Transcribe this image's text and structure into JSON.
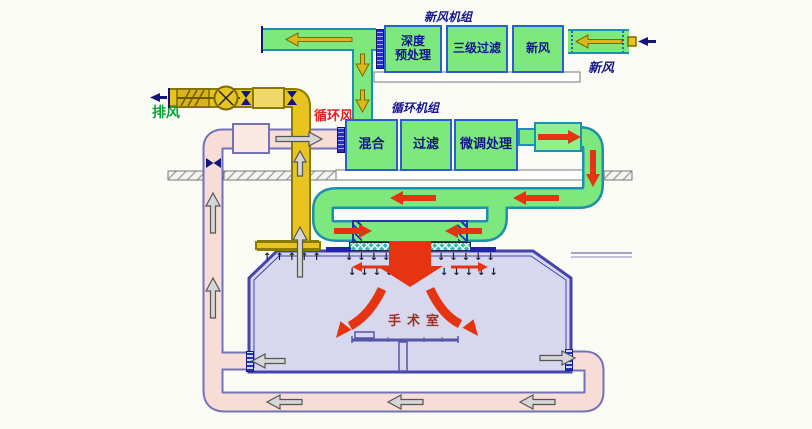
{
  "colors": {
    "green": "#7de87d",
    "duct_border": "#1e8fae",
    "box_border": "#2b5fd0",
    "yellow": "#e7c41f",
    "yellow_dark": "#8a7a00",
    "pink": "#f7ddd6",
    "pink_border": "#7272bb",
    "room_fill": "#d7d7ee",
    "wall": "#4444aa",
    "red": "#e63312",
    "teal_filter": "#36b8b8",
    "navy": "#15158a",
    "label_green": "#09a23c",
    "label_red": "#e02020",
    "room_label": "#993322",
    "gray_arrow": "#d6d6d6"
  },
  "fresh_air_unit": {
    "label": "新风机组",
    "box1_line1": "深度",
    "box1_line2": "预处理",
    "box2": "三级过滤",
    "box3": "新风",
    "inlet_label": "新风"
  },
  "circulation_unit": {
    "label": "循环机组",
    "box1": "混合",
    "box2": "过滤",
    "box3": "微调处理"
  },
  "exhaust_label": "排风",
  "circulating_air_label": "循环风",
  "room": {
    "label": "手术室"
  },
  "glyphs": {
    "down_row_left": "↓↓↓↓",
    "down_row_right": "↓↓↓↓↓",
    "up_row": "↑↑↑↑↑"
  }
}
